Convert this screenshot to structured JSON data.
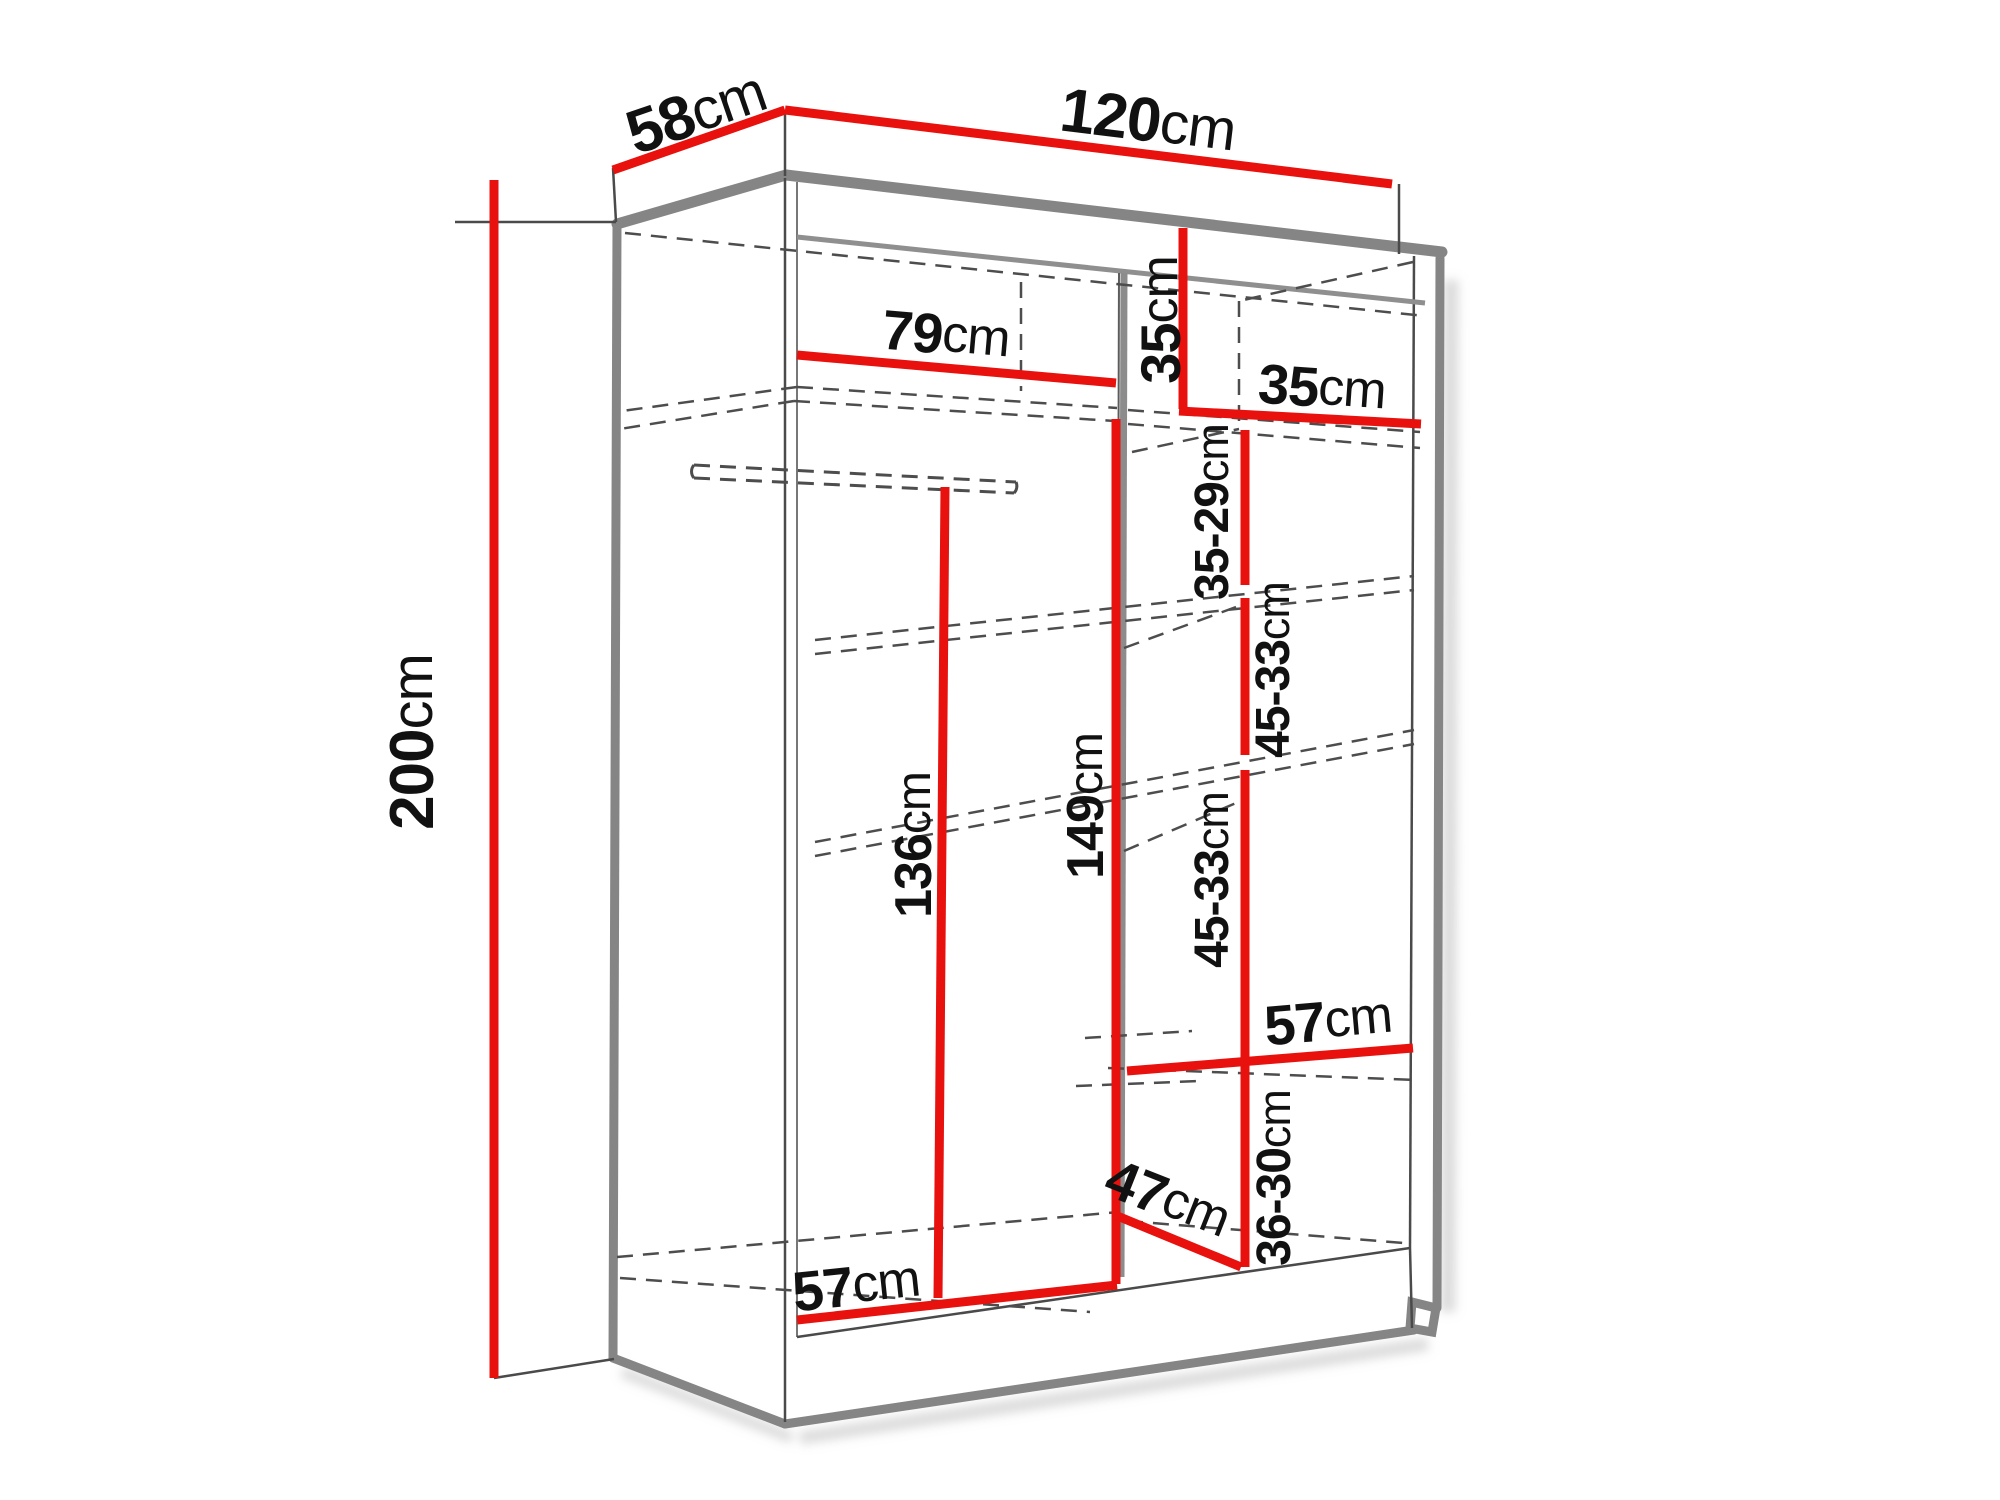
{
  "diagram": {
    "kind": "wardrobe interior dimension drawing",
    "unit": "cm",
    "accent_color": "#e8110d",
    "outline_color": "#858585"
  },
  "dims": {
    "depth58": {
      "value": "58",
      "unit": "cm",
      "meaning": "total depth"
    },
    "width120": {
      "value": "120",
      "unit": "cm",
      "meaning": "total width"
    },
    "height200": {
      "value": "200",
      "unit": "cm",
      "meaning": "total height"
    },
    "leftWidth79": {
      "value": "79",
      "unit": "cm",
      "meaning": "left section width"
    },
    "cubbyH35": {
      "value": "35",
      "unit": "cm",
      "meaning": "top right cubby height"
    },
    "cubbyW35": {
      "value": "35",
      "unit": "cm",
      "meaning": "top right cubby width"
    },
    "gap3529": {
      "value": "35-29",
      "unit": "cm",
      "meaning": "shelf spacing 1"
    },
    "gap4533a": {
      "value": "45-33",
      "unit": "cm",
      "meaning": "shelf spacing 2"
    },
    "gap4533b": {
      "value": "45-33",
      "unit": "cm",
      "meaning": "shelf spacing 3"
    },
    "rightW57": {
      "value": "57",
      "unit": "cm",
      "meaning": "right section width"
    },
    "gap3630": {
      "value": "36-30",
      "unit": "cm",
      "meaning": "bottom shelf spacing"
    },
    "depth47": {
      "value": "47",
      "unit": "cm",
      "meaning": "bottom compartment depth"
    },
    "hang136": {
      "value": "136",
      "unit": "cm",
      "meaning": "hanging space height"
    },
    "right149": {
      "value": "149",
      "unit": "cm",
      "meaning": "right section height"
    },
    "bottomW57": {
      "value": "57",
      "unit": "cm",
      "meaning": "bottom left width"
    }
  }
}
